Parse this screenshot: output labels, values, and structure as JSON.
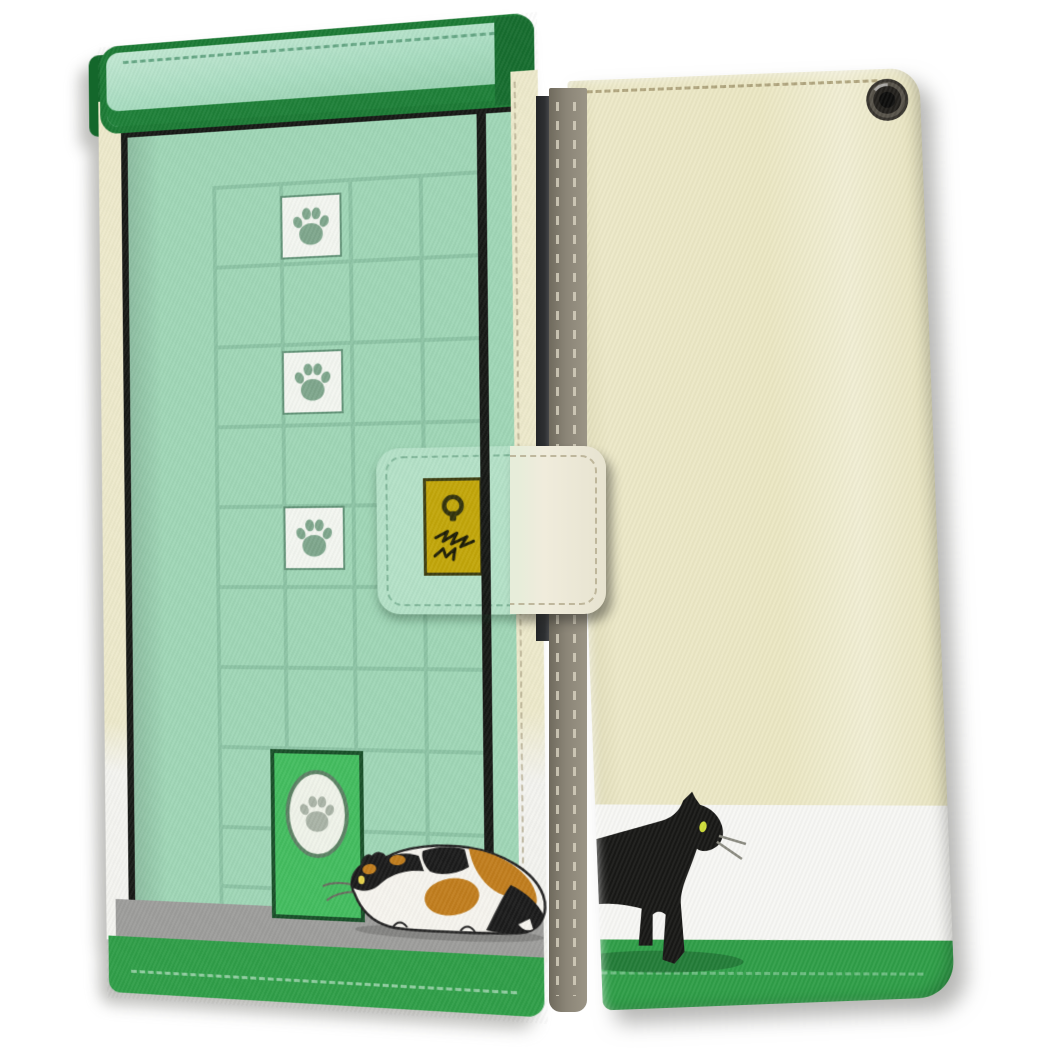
{
  "photo": {
    "subject": "Wallet-style flip phone case product photo showing front cover with green cat-door illustration and back cover with black cat silhouette",
    "front_cover_theme": "mint green tiled door with paw-print tiles, cat flap, calico cat, clasp strap with yellow keyhole plate and scratch marks",
    "back_cover_theme": "cream leather with walking black cat on green base band, camera eyelet, stitched edges"
  },
  "colors": {
    "page_bg": "#ffffff",
    "mint": "#9fd6b6",
    "mint_bar": "#a8dcc0",
    "bar_border": "#1b7a34",
    "bar_shade": "#1e8038",
    "grid_line": "#8cc3a4",
    "frame_black": "#161815",
    "cream": "#ece8c7",
    "cream_edge": "#ede9cb",
    "white_band": "#f7f7f4",
    "band_green": "#2f9e48",
    "floor_gray": "#9d9d9b",
    "flap_green": "#43bd5f",
    "flap_border": "#184f28",
    "paw_green": "#7ea68c",
    "paw_gray": "#a9b3a6",
    "tile_white": "#f3f6f0",
    "tile_border": "#639478",
    "plate_yellow": "#c2a609",
    "plate_border": "#3e3e10",
    "clasp_mint": "#b4e1c7",
    "clasp_cream": "#f0ecdc",
    "spine_gray": "#8b8577",
    "stitch_spine": "#d9d3c1",
    "stitch_mint": "#67a886",
    "stitch_cream": "#a89c74",
    "stitch_green": "#a6d8b4",
    "phone_dark": "#2e3032",
    "cat_orange": "#c17d1d",
    "cat_black": "#1b1b1b",
    "cat_white": "#f6f4ee",
    "eye_yellow": "#e6d24b",
    "eye_green": "#cfdd3a"
  },
  "front_cover": {
    "door_grid": {
      "column_x": [
        120,
        189,
        259,
        329
      ],
      "row_y": [
        150,
        231,
        312,
        393,
        474,
        555,
        636,
        717,
        798,
        858
      ]
    },
    "paw_tiles": {
      "x": 190,
      "row_y": [
        164,
        320,
        476
      ],
      "count": 3
    },
    "cat_flap_paw": 1,
    "calico_cat_count": 1
  },
  "back_cover": {
    "black_cat_count": 1,
    "camera_eyelet_count": 1
  }
}
